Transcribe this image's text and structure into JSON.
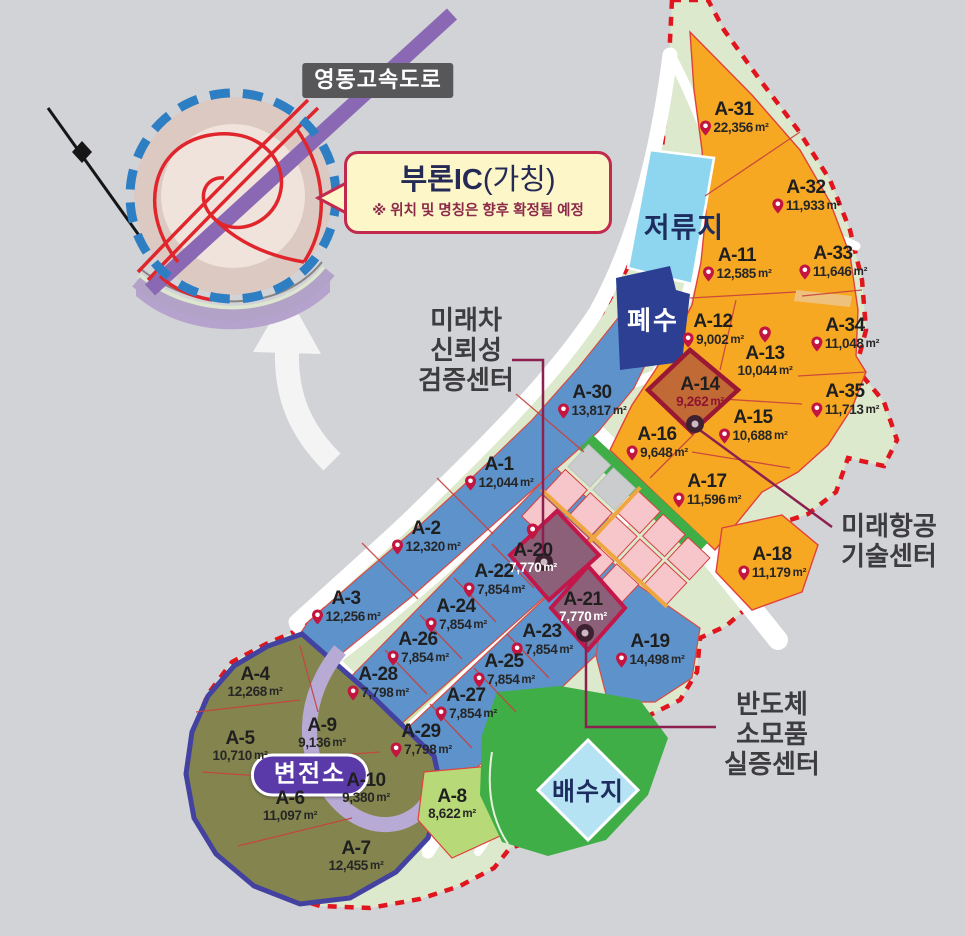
{
  "area_unit": "m²",
  "colors": {
    "background": "#d2d3d6",
    "boundary_dashed": "#e0151d",
    "boundary_band": "#dde9cc",
    "lot_orange": "#f7a823",
    "lot_blue": "#5e92cb",
    "lot_olive": "#84854e",
    "lot_green": "#b8d977",
    "highlight_mauve": "#8c6078",
    "highlight_brown": "#c16a35",
    "highlight_border": "#c2174a",
    "pin": "#c2153f",
    "retention_pond_fill": "#8ed6f0",
    "wastewater_fill": "#2c3f93",
    "reservoir_fill": "#b5e3f3",
    "park_green": "#3fae47",
    "substation_pill": "#5a3aa8",
    "highway_purple": "#8a68b3",
    "inset_ring_blue": "#2e7ec3"
  },
  "inset": {
    "highway_label": "영동고속도로",
    "callout": {
      "title": "부론IC",
      "title_suffix": "(가칭)",
      "note": "※ 위치 및 명칭은 향후 확정될 예정"
    }
  },
  "facilities": {
    "retention_pond": "저류지",
    "wastewater": "폐수",
    "reservoir": "배수지",
    "substation": "변전소"
  },
  "annotations": {
    "future_car": {
      "lines": [
        "미래차",
        "신뢰성",
        "검증센터"
      ]
    },
    "future_aviation": {
      "lines": [
        "미래항공",
        "기술센터"
      ]
    },
    "semiconductor": {
      "lines": [
        "반도체",
        "소모품",
        "실증센터"
      ]
    }
  },
  "lots": [
    {
      "id": "A-31",
      "area": "22,356",
      "x": 734,
      "y": 118,
      "type": "orange",
      "pin": "left"
    },
    {
      "id": "A-32",
      "area": "11,933",
      "x": 806,
      "y": 196,
      "type": "orange",
      "pin": "left"
    },
    {
      "id": "A-11",
      "area": "12,585",
      "x": 737,
      "y": 264,
      "type": "orange",
      "pin": "left"
    },
    {
      "id": "A-33",
      "area": "11,646",
      "x": 833,
      "y": 262,
      "type": "orange",
      "pin": "left"
    },
    {
      "id": "A-12",
      "area": "9,002",
      "x": 713,
      "y": 330,
      "type": "orange",
      "pin": "left"
    },
    {
      "id": "A-13",
      "area": "10,044",
      "x": 765,
      "y": 352,
      "type": "orange",
      "pin": "top"
    },
    {
      "id": "A-34",
      "area": "11,048",
      "x": 845,
      "y": 334,
      "type": "orange",
      "pin": "left"
    },
    {
      "id": "A-14",
      "area": "9,262",
      "x": 700,
      "y": 392,
      "type": "hl_brown",
      "pin": "none"
    },
    {
      "id": "A-16",
      "area": "9,648",
      "x": 657,
      "y": 443,
      "type": "orange",
      "pin": "left"
    },
    {
      "id": "A-15",
      "area": "10,688",
      "x": 753,
      "y": 426,
      "type": "orange",
      "pin": "left"
    },
    {
      "id": "A-35",
      "area": "11,713",
      "x": 845,
      "y": 400,
      "type": "orange",
      "pin": "left"
    },
    {
      "id": "A-17",
      "area": "11,596",
      "x": 707,
      "y": 490,
      "type": "orange",
      "pin": "left"
    },
    {
      "id": "A-18",
      "area": "11,179",
      "x": 772,
      "y": 563,
      "type": "orange",
      "pin": "left"
    },
    {
      "id": "A-30",
      "area": "13,817",
      "x": 592,
      "y": 401,
      "type": "blue",
      "pin": "left"
    },
    {
      "id": "A-1",
      "area": "12,044",
      "x": 499,
      "y": 473,
      "type": "blue",
      "pin": "left"
    },
    {
      "id": "A-2",
      "area": "12,320",
      "x": 426,
      "y": 537,
      "type": "blue",
      "pin": "left"
    },
    {
      "id": "A-3",
      "area": "12,256",
      "x": 346,
      "y": 607,
      "type": "blue",
      "pin": "left"
    },
    {
      "id": "A-20",
      "area": "7,770",
      "x": 533,
      "y": 549,
      "type": "hl_mauve",
      "pin": "top"
    },
    {
      "id": "A-22",
      "area": "7,854",
      "x": 494,
      "y": 580,
      "type": "blue",
      "pin": "left"
    },
    {
      "id": "A-21",
      "area": "7,770",
      "x": 583,
      "y": 607,
      "type": "hl_mauve",
      "pin": "none"
    },
    {
      "id": "A-24",
      "area": "7,854",
      "x": 456,
      "y": 615,
      "type": "blue",
      "pin": "left"
    },
    {
      "id": "A-23",
      "area": "7,854",
      "x": 542,
      "y": 640,
      "type": "blue",
      "pin": "left"
    },
    {
      "id": "A-26",
      "area": "7,854",
      "x": 418,
      "y": 648,
      "type": "blue",
      "pin": "left"
    },
    {
      "id": "A-25",
      "area": "7,854",
      "x": 504,
      "y": 670,
      "type": "blue",
      "pin": "left"
    },
    {
      "id": "A-28",
      "area": "7,798",
      "x": 378,
      "y": 683,
      "type": "blue",
      "pin": "left"
    },
    {
      "id": "A-27",
      "area": "7,854",
      "x": 466,
      "y": 704,
      "type": "blue",
      "pin": "left"
    },
    {
      "id": "A-29",
      "area": "7,798",
      "x": 421,
      "y": 740,
      "type": "blue",
      "pin": "left"
    },
    {
      "id": "A-19",
      "area": "14,498",
      "x": 650,
      "y": 650,
      "type": "blue",
      "pin": "left"
    },
    {
      "id": "A-4",
      "area": "12,268",
      "x": 255,
      "y": 682,
      "type": "olive",
      "pin": "none"
    },
    {
      "id": "A-9",
      "area": "9,136",
      "x": 322,
      "y": 733,
      "type": "olive",
      "pin": "none"
    },
    {
      "id": "A-5",
      "area": "10,710",
      "x": 240,
      "y": 746,
      "type": "olive",
      "pin": "none"
    },
    {
      "id": "A-10",
      "area": "9,380",
      "x": 366,
      "y": 788,
      "type": "olive",
      "pin": "none"
    },
    {
      "id": "A-6",
      "area": "11,097",
      "x": 290,
      "y": 806,
      "type": "olive",
      "pin": "none"
    },
    {
      "id": "A-8",
      "area": "8,622",
      "x": 452,
      "y": 804,
      "type": "green",
      "pin": "none"
    },
    {
      "id": "A-7",
      "area": "12,455",
      "x": 356,
      "y": 856,
      "type": "olive",
      "pin": "none"
    }
  ]
}
